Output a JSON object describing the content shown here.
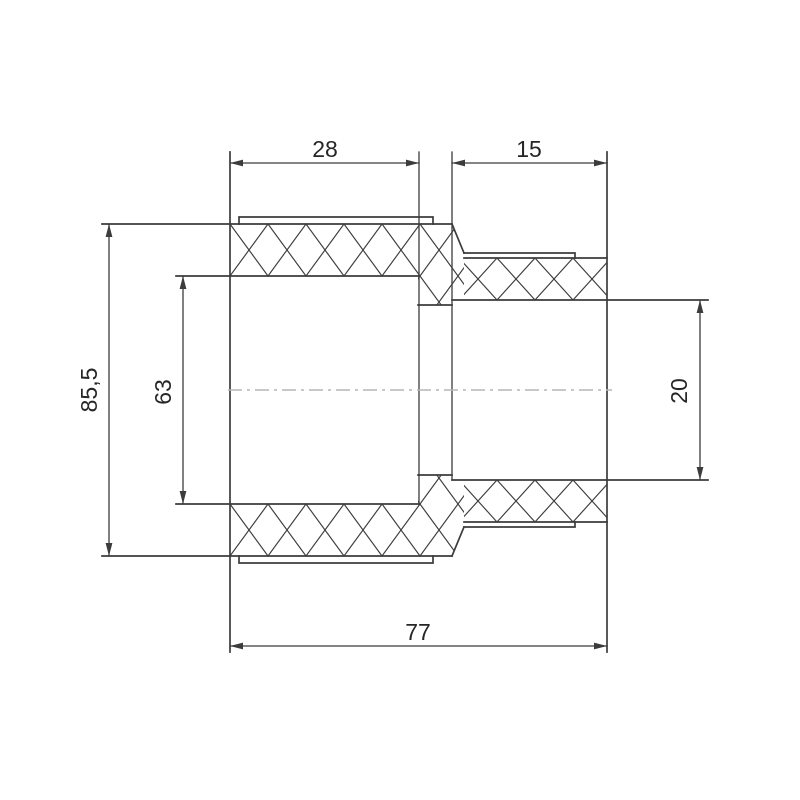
{
  "drawing": {
    "type": "technical-drawing-cross-section",
    "subject": "pipe-reducer-coupling",
    "colors": {
      "background": "#ffffff",
      "line": "#3c3c3c",
      "centerline": "#b5b5b5",
      "text": "#262626"
    },
    "dimensions": {
      "left_socket_depth": {
        "label": "28"
      },
      "right_socket_depth": {
        "label": "15"
      },
      "body_outer_diameter": {
        "label": "85,5"
      },
      "left_bore_diameter": {
        "label": "63"
      },
      "right_bore_diameter": {
        "label": "20"
      },
      "overall_length": {
        "label": "77"
      }
    }
  }
}
